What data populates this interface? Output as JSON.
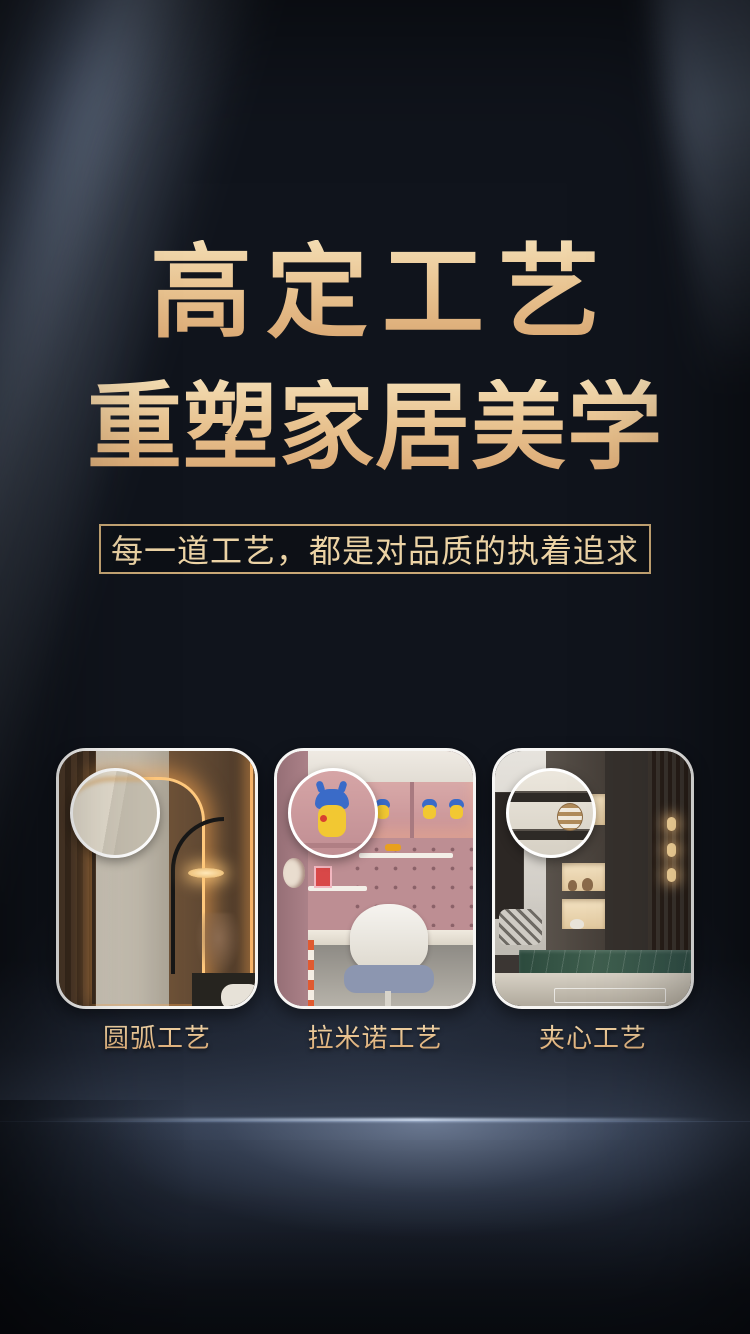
{
  "hero": {
    "title_line1": "高定工艺",
    "title_line2": "重塑家居美学",
    "subtitle": "每一道工艺，都是对品质的执着追求"
  },
  "cards": [
    {
      "label": "圆弧工艺",
      "photo": "bedroom-rounded-corner-cabinet-with-arc-floor-lamp"
    },
    {
      "label": "拉米诺工艺",
      "photo": "kids-study-room-pegboard-desk-with-figures"
    },
    {
      "label": "夹心工艺",
      "photo": "living-room-lit-display-shelves-marble-base"
    }
  ],
  "colors": {
    "background": "#10141c",
    "title_gold_light": "#f3dcb2",
    "title_gold_dark": "#d9a671",
    "subtitle_text": "#ecd3a5",
    "subtitle_border": "#c9a876",
    "caption_gold": "#dcb887",
    "card_border": "#f7f6f4",
    "floor_highlight": "#d4e2f6"
  }
}
